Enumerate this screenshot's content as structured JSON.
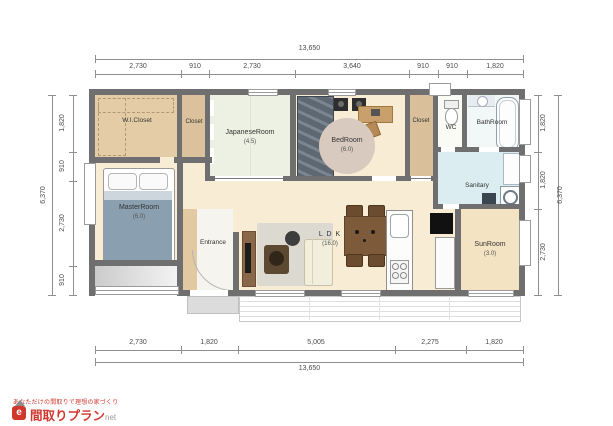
{
  "plan": {
    "rooms": {
      "wic": {
        "label": "W.I.Closet"
      },
      "closet_north": {
        "label": "Closet"
      },
      "japanese": {
        "label": "JapaneseRoom",
        "size": "(4.5)"
      },
      "bedroom": {
        "label": "BedRoom",
        "size": "(6.0)"
      },
      "closet_east": {
        "label": "Closet"
      },
      "wc": {
        "label": "WC"
      },
      "bathroom": {
        "label": "BathRoom"
      },
      "master": {
        "label": "MasterRoom",
        "size": "(6.0)"
      },
      "entrance": {
        "label": "Entrance"
      },
      "ldk": {
        "label": "L D K",
        "size": "(16.0)"
      },
      "sanitary": {
        "label": "Sanitary"
      },
      "sunroom": {
        "label": "SunRoom",
        "size": "(3.0)"
      }
    }
  },
  "dimensions": {
    "top": {
      "total": "13,650",
      "segments": [
        "2,730",
        "910",
        "2,730",
        "3,640",
        "910",
        "910",
        "1,820"
      ]
    },
    "bottom": {
      "total": "13,650",
      "segments": [
        "2,730",
        "1,820",
        "5,005",
        "2,275",
        "1,820"
      ]
    },
    "left": {
      "total": "6,370",
      "segments": [
        "1,820",
        "910",
        "2,730",
        "910"
      ]
    },
    "right": {
      "total": "6,370",
      "segments": [
        "1,820",
        "1,820",
        "2,730"
      ]
    }
  },
  "logo": {
    "tagline": "あなただけの間取りで理想の家づくり",
    "icon_letter": "e",
    "brand": "間取りプラン",
    "suffix": "net"
  },
  "colors": {
    "logo_red": "#d0382e",
    "wall_gray": "#6f6f6f",
    "wood_floor": "#f8ecd4",
    "tatami_green": "#edf1e3",
    "wet_area_blue": "#dcedf2",
    "closet_tan": "#e2c9a2"
  }
}
